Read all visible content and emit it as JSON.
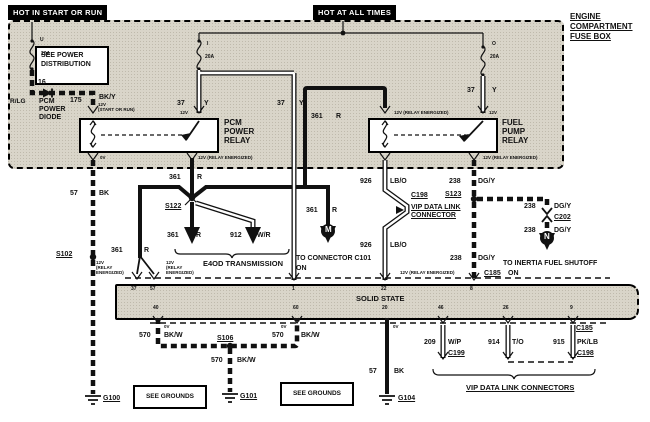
{
  "banners": {
    "hot_in_start_or_run": "HOT IN START OR RUN",
    "hot_at_all_times": "HOT AT ALL TIMES",
    "engine_fuse_box": [
      "ENGINE",
      "COMPARTMENT",
      "FUSE BOX"
    ]
  },
  "fuses": {
    "left": {
      "id": "U",
      "rating": "20A",
      "circuit": "16"
    },
    "middle": {
      "id": "I",
      "rating": "20A"
    },
    "right": {
      "id": "O",
      "rating": "20A"
    }
  },
  "relays": {
    "pcm": {
      "name": "PCM\nPOWER\nRELAY"
    },
    "fuel": {
      "name": "FUEL\nPUMP\nRELAY"
    }
  },
  "boxes": {
    "see_power_distribution": "SEE POWER DISTRIBUTION",
    "see_grounds": "SEE GROUNDS",
    "solid_state": "SOLID STATE"
  },
  "components": {
    "pcm_power_diode": "PCM\nPOWER\nDIODE",
    "e4od_transmission": "E4OD TRANSMISSION",
    "vip_data_link_connector": "VIP DATA LINK\nCONNECTOR",
    "vip_data_link_connectors": "VIP DATA LINK CONNECTORS"
  },
  "wires": {
    "rlg": "R/LG",
    "w175": "175",
    "bky": "BK/Y",
    "w37": "37",
    "y": "Y",
    "w361": "361",
    "r": "R",
    "w57": "57",
    "bk": "BK",
    "w912": "912",
    "wr": "W/R",
    "w926": "926",
    "lbo": "LB/O",
    "w238": "238",
    "dgy": "DG/Y",
    "w570": "570",
    "bkw": "BK/W",
    "w209": "209",
    "wp": "W/P",
    "w914": "914",
    "to": "T/O",
    "w915": "915",
    "pklb": "PK/LB"
  },
  "voltages": {
    "v12": "12V",
    "v0": "0V",
    "v12_start_or_run": "12V\n(START OR RUN)",
    "v12_relay_energized": "12V (RELAY ENERGIZED)",
    "v12_relay_energized_stacked": "12V\n(RELAY\nENERGIZED)"
  },
  "splices": {
    "s102": "S102",
    "s106": "S106",
    "s122": "S122",
    "s123": "S123"
  },
  "connectors": {
    "c185": "C185",
    "c198": "C198",
    "c199": "C199",
    "c202": "C202"
  },
  "grounds": {
    "g100": "G100",
    "g101": "G101",
    "g104": "G104"
  },
  "notes": {
    "to_connector_c101": "TO CONNECTOR C101",
    "to_inertia_fuel_shutoff": "TO INERTIA FUEL SHUTOFF",
    "on": "ON",
    "m": "M",
    "n": "N"
  },
  "pins": {
    "p37": "37",
    "p57": "57",
    "p1": "1",
    "p22": "22",
    "p8": "8",
    "p40": "40",
    "p60": "60",
    "p20": "20",
    "p46": "46",
    "p26": "26",
    "p9": "9"
  },
  "colors": {
    "panel": "#d9d5c9",
    "line": "#111111",
    "background": "#ffffff"
  }
}
